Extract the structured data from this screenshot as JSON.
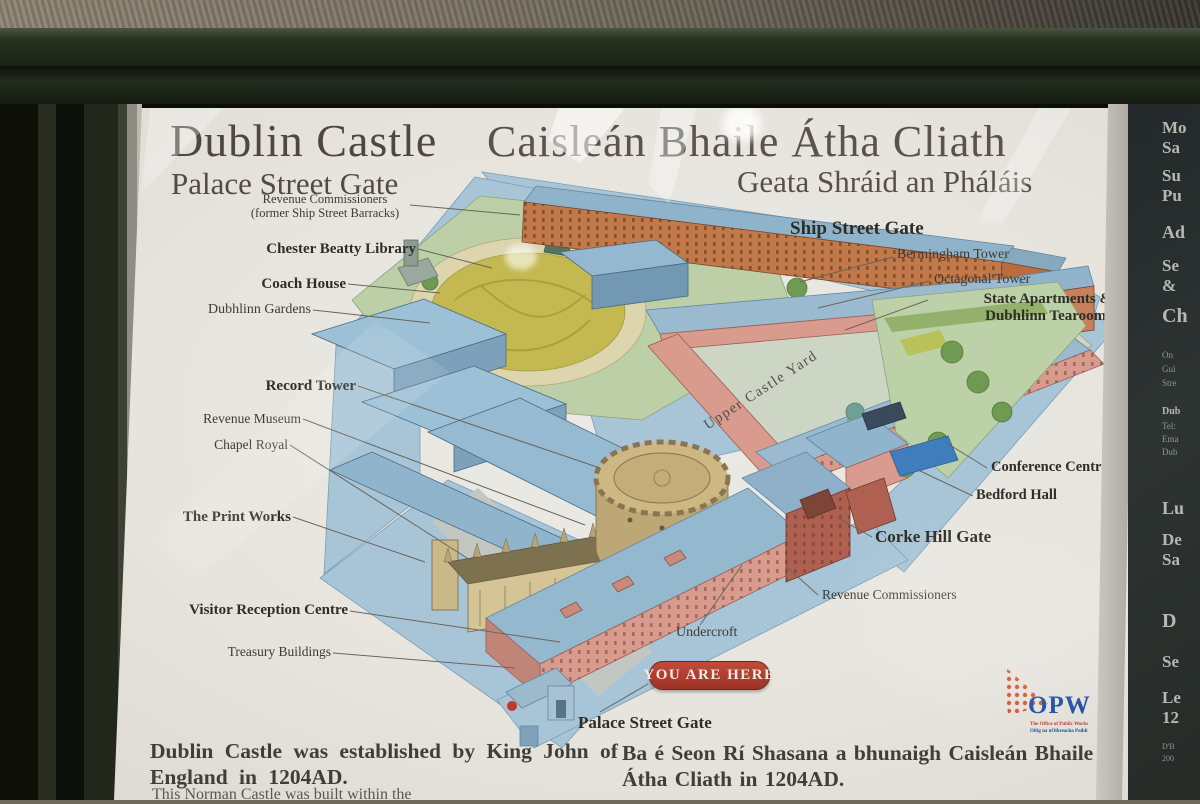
{
  "sign": {
    "title_en": "Dublin Castle",
    "subtitle_en": "Palace Street Gate",
    "title_ga": "Caisleán Bhaile Átha Cliath",
    "subtitle_ga": "Geata Shráid an Pháláis",
    "footer_en_line1": "Dublin Castle was established by King John of",
    "footer_en_line2": "England in 1204AD.",
    "footer_en_partial": "This Norman Castle was built within the",
    "footer_ga_line1": "Ba é Seon Rí Shasana a bhunaigh Caisleán Bhaile",
    "footer_ga_line2": "Átha Cliath in 1204AD."
  },
  "map": {
    "you_are_here": "YOU ARE HERE",
    "yard_label": "Upper Castle Yard",
    "labels": [
      {
        "text": "Revenue Commissioners",
        "text2": "(former Ship Street Barracks)"
      },
      {
        "text": "Chester Beatty Library"
      },
      {
        "text": "Coach House"
      },
      {
        "text": "Dubhlinn Gardens"
      },
      {
        "text": "Record Tower"
      },
      {
        "text": "Revenue Museum"
      },
      {
        "text": "Chapel Royal"
      },
      {
        "text": "The Print Works"
      },
      {
        "text": "Visitor Reception Centre"
      },
      {
        "text": "Treasury Buildings"
      },
      {
        "text": "Ship Street Gate"
      },
      {
        "text": "Bermingham Tower"
      },
      {
        "text": "Octagonal Tower"
      },
      {
        "text": "State Apartments &",
        "text2": "Dubhlinn Tearooms"
      },
      {
        "text": "Conference Centre"
      },
      {
        "text": "Bedford Hall"
      },
      {
        "text": "Corke Hill Gate"
      },
      {
        "text": "Revenue Commissioners"
      },
      {
        "text": "Undercroft"
      },
      {
        "text": "Palace Street Gate"
      }
    ]
  },
  "opw": {
    "acronym": "OPW",
    "line1": "The Office of Public Works",
    "line2": "Oifig na nOibreacha Poiblí"
  },
  "side_panel": {
    "fragments": [
      "Mo",
      "Sa",
      "Su",
      "Pu",
      "Ad",
      "Se",
      "&",
      "Ch",
      "On",
      "Gui",
      "Stre",
      "Dub",
      "Tel:",
      "Ema",
      "Dub",
      "Lu",
      "De",
      "Sa",
      "D",
      "Se",
      "Le",
      "12",
      "D'B",
      "200"
    ]
  },
  "colors": {
    "badge_red": "#a93b2e",
    "opw_blue": "#1b4aa0",
    "opw_orange": "#d8502a",
    "paper": "#e7e4de",
    "frame_green": "#20281e",
    "street_blue": "#a8c5d8",
    "lawn_yellow": "#c4b851",
    "building_salmon": "#d89b8d",
    "building_orange": "#c2794a",
    "roof_blue": "#93b7cf",
    "yard_green": "#cdd6c5"
  }
}
